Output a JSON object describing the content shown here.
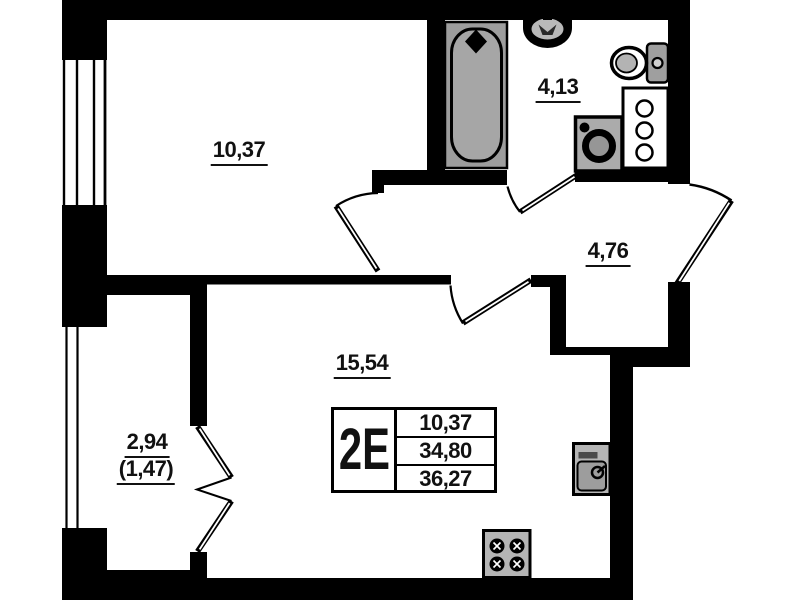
{
  "plan_title": "2E",
  "rooms": [
    {
      "key": "bedroom",
      "area": "10,37"
    },
    {
      "key": "bathroom",
      "area": "4,13"
    },
    {
      "key": "hallway",
      "area": "4,76"
    },
    {
      "key": "living_kitchen",
      "area": "15,54"
    },
    {
      "key": "balcony",
      "area": "2,94",
      "area_coefficient": "(1,47)"
    }
  ],
  "info_table": {
    "unit_type": "2E",
    "values": [
      "10,37",
      "34,80",
      "36,27"
    ]
  },
  "fixtures": [
    "bathtub",
    "wash-basin",
    "toilet",
    "shelf-unit",
    "washing-machine",
    "kitchen-sink",
    "stove"
  ],
  "colors": {
    "walls": "#000000",
    "fixture_gray": "#a0a0a0",
    "background": "#ffffff",
    "text": "#111111"
  }
}
